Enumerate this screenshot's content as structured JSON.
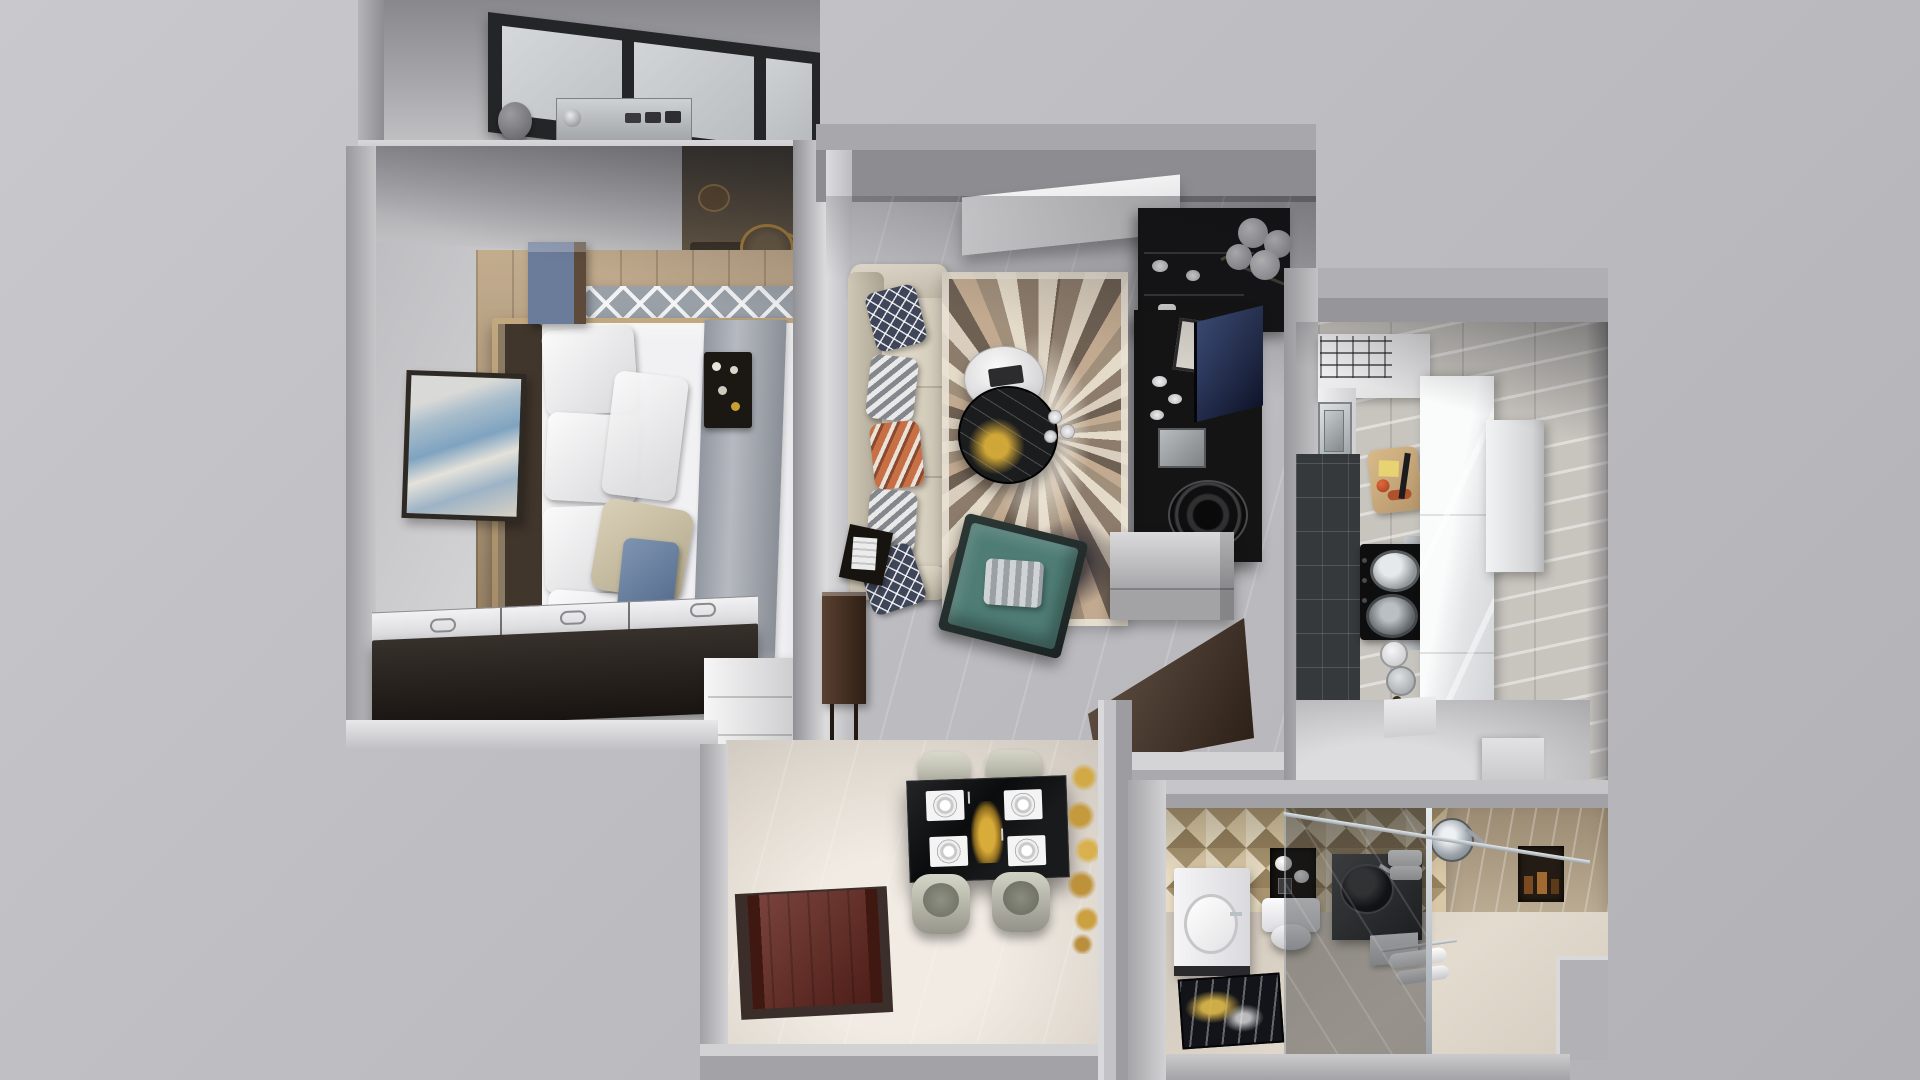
{
  "app": {
    "type": "3d-apartment-floorplan-render",
    "view": "top-down-dollhouse",
    "visible_text": "none"
  },
  "rooms": [
    {
      "name": "balcony-laundry",
      "items": [
        "skylight-window",
        "washing-machine",
        "planter-pot"
      ]
    },
    {
      "name": "bedroom",
      "items": [
        "double-bed",
        "headboard",
        "white-pillows",
        "beige-pillow",
        "blue-accent-cushion",
        "gray-bed-runner",
        "breakfast-tray",
        "blue-nightstand",
        "coastal-wall-art",
        "trellis-rug",
        "wood-floor",
        "dark-storage-bench",
        "white-shoe-cabinet",
        "wardrobe-nook",
        "gold-stool",
        "basket"
      ]
    },
    {
      "name": "living-room",
      "items": [
        "cream-sofa",
        "navy-diamond-pillows",
        "chevron-pillows",
        "orange-accent-pillow",
        "feather-pattern-rug",
        "white-round-coffee-table",
        "black-marble-coffee-table",
        "tea-cups",
        "gold-decor-splash",
        "teal-lounge-chair",
        "striped-cushion",
        "black-media-shelf",
        "pompom-plant",
        "tv-screen",
        "framed-picture",
        "round-speaker",
        "white-dishes",
        "gray-wall-cabinet",
        "walnut-desk",
        "walnut-console",
        "recessed-light-panel",
        "magazine-side-table"
      ]
    },
    {
      "name": "kitchen",
      "items": [
        "stainless-sink",
        "gas-cooktop",
        "pots",
        "range-hood",
        "cutting-board",
        "cheese",
        "tomato",
        "knife",
        "spice-jars",
        "tall-white-cabinet",
        "refrigerator",
        "marble-wall",
        "dark-tile-backsplash",
        "ceiling-vent-panel",
        "floor-steps"
      ]
    },
    {
      "name": "dining-entry",
      "items": [
        "black-dining-table",
        "place-settings",
        "gold-centerpiece",
        "cream-barrel-chairs",
        "red-door-mat",
        "gold-wall-art",
        "marble-floor"
      ]
    },
    {
      "name": "bathroom",
      "items": [
        "white-vanity",
        "oval-basin",
        "toilet",
        "tissue-niche",
        "paper-rolls",
        "dark-vessel-sink",
        "towel-stack",
        "glass-shower-partition",
        "rain-shower-head",
        "shower-niche-bottles",
        "towel-rack",
        "white-towels",
        "gold-marble-mat",
        "diamond-tile-wall",
        "marble-shower-wall",
        "step-stool"
      ]
    }
  ],
  "colors": {
    "bg_outer": "#bfbfc3",
    "wall_face": "#c9c9cd",
    "wall_side": "#a2a2a6",
    "window_frame": "#232527",
    "window_glass": "#ced1d3",
    "washer_steel": "#b7babd",
    "wood_floor": "#b59a76",
    "rug_gray": "#99a0a8",
    "headboard": "#41362c",
    "bed_white": "#f1f1f3",
    "blanket_gray": "#a6aaaf",
    "pillow_beige": "#cbc1a8",
    "accent_blue": "#6f8cad",
    "nightstand_blue": "#6b7b9a",
    "tray_black": "#1b1713",
    "bench_dark": "#261f1a",
    "chest_white": "#e9e9eb",
    "art_frame": "#2e2923",
    "living_floor": "#cfc8bf",
    "sofa_cream": "#d8d1c2",
    "pillow_navy": "#3f4659",
    "pillow_orange": "#c96f45",
    "rug_base": "#d2c6b6",
    "coffee_black": "#1b1c1e",
    "coffee_white": "#eceef0",
    "gold": "#c79f35",
    "teal_chair": "#4f7d76",
    "media_black": "#141415",
    "tv_screen": "#1d2746",
    "cabinet_gray": "#b5b5b9",
    "desk_walnut": "#4a3526",
    "dark_tile": "#35393c",
    "cooktop_black": "#0e0e0f",
    "kitchen_white": "#eef0f1",
    "hall_floor": "#e2dcd4",
    "dining_table": "#0b0c0e",
    "chair_sage": "#c9c9ba",
    "mat_red": "#66261e",
    "bath_tile": "#c9b795",
    "vanity_white": "#f1f1f3",
    "glass_tint": "rgba(25,28,32,0.38)",
    "chrome": "#c3cad0",
    "gold_art": "#c49a3c"
  }
}
